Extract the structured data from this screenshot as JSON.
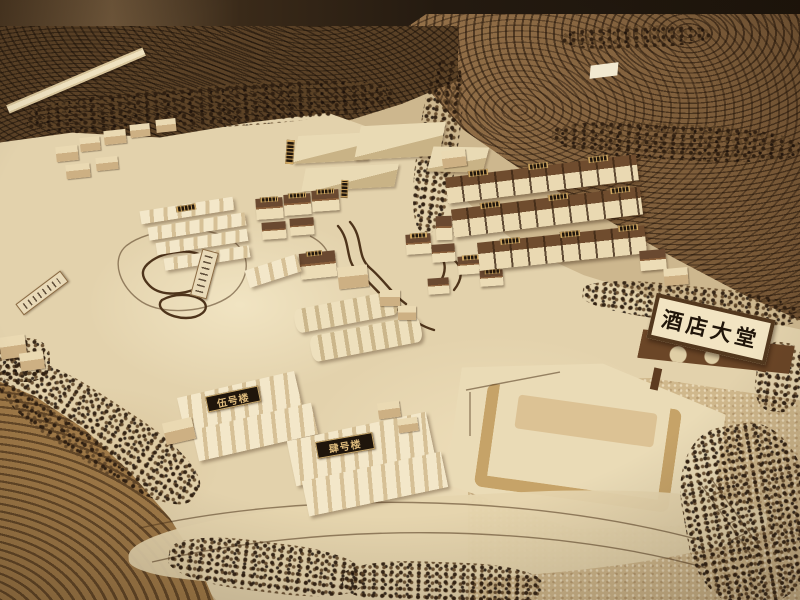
{
  "labels": {
    "hotel_lobby_sign": "酒店大堂",
    "building_5_label": "伍号楼",
    "building_4_label": "肆号楼"
  },
  "palette": {
    "terrain_dark": "#5a4126",
    "terrace_tan": "#86623c",
    "site_cream": "#e3d2ac",
    "wood_light": "#f0e2c0",
    "roof_brown": "#6f4c2e",
    "sign_face": "#f2e4c2",
    "sign_border": "#53381e",
    "label_bg": "#1f150b",
    "label_gold": "#dcb97b",
    "water_sand": "#d0b88c",
    "tree_dark": "#2e1e10"
  }
}
